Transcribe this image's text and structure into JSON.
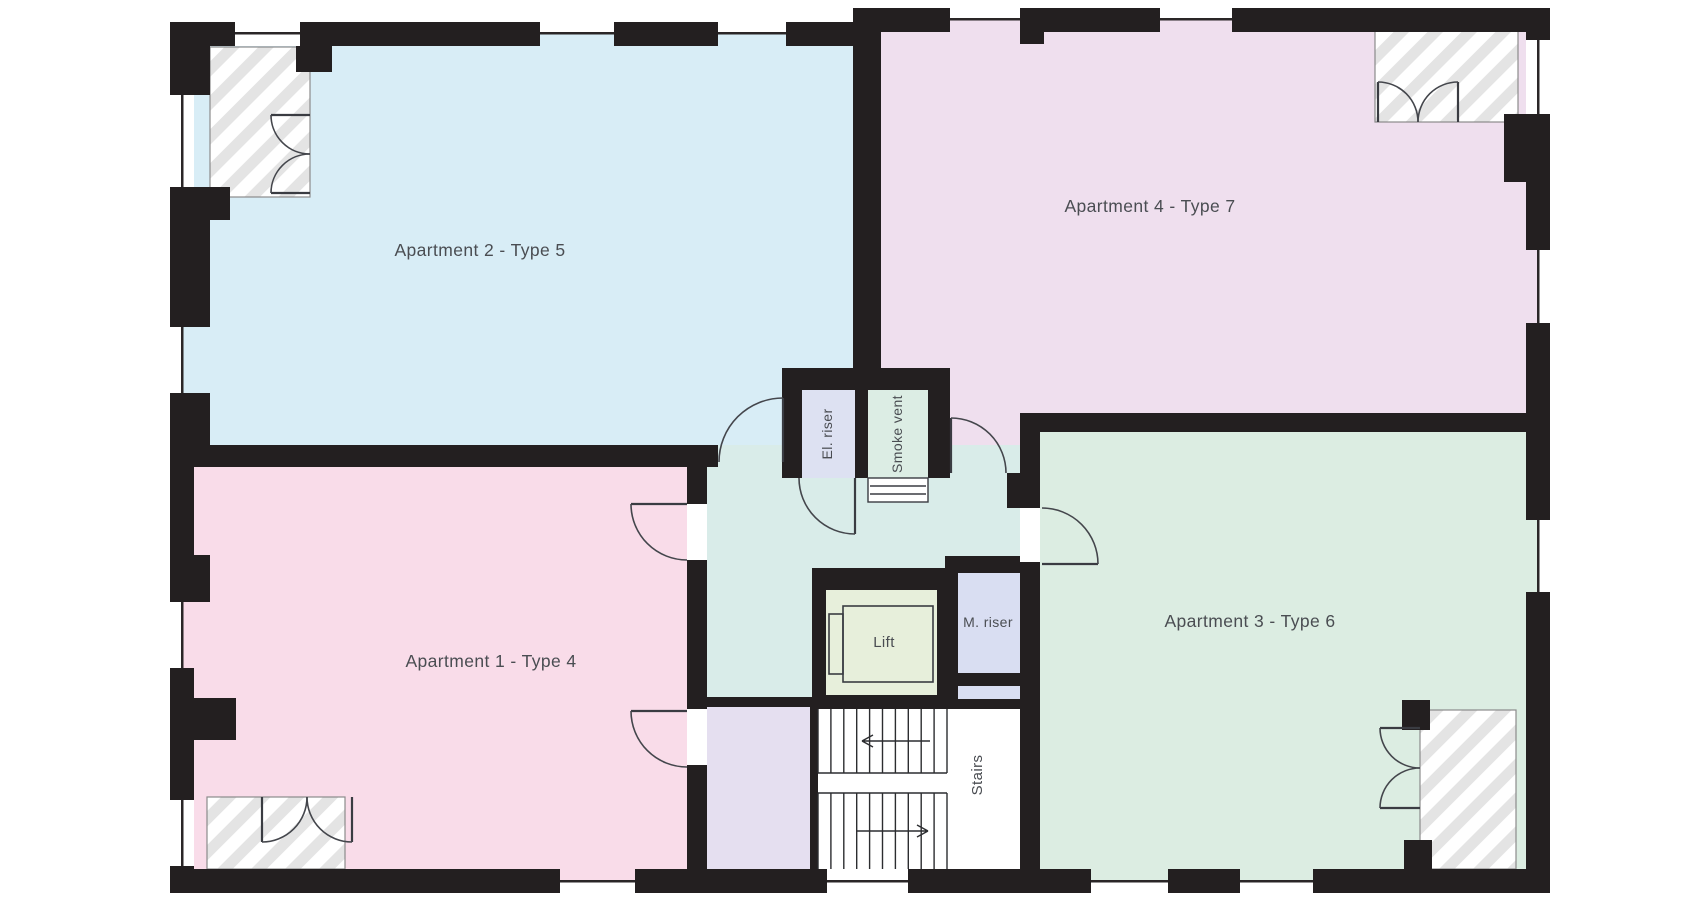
{
  "rooms": {
    "apartment_1": {
      "label": "Apartment 1 - Type 4",
      "color": "#f9dce9"
    },
    "apartment_2": {
      "label": "Apartment 2 - Type 5",
      "color": "#d8edf6"
    },
    "apartment_3": {
      "label": "Apartment 3 - Type 6",
      "color": "#dcede2"
    },
    "apartment_4": {
      "label": "Apartment 4 - Type 7",
      "color": "#efdfee"
    },
    "el_riser": {
      "label": "El. riser",
      "color": "#dde1f2"
    },
    "smoke_vent": {
      "label": "Smoke vent",
      "color": "#dcede4"
    },
    "lift": {
      "label": "Lift",
      "color": "#e7efdb"
    },
    "m_riser": {
      "label": "M. riser",
      "color": "#d9def2"
    },
    "stairs": {
      "label": "Stairs",
      "color": "#ffffff"
    },
    "corridor": {
      "color": "#d9ece9"
    },
    "lobby": {
      "color": "#e5dff0"
    }
  },
  "colors": {
    "wall": "#231f20",
    "label_text": "#4a4d52",
    "hatch": "#e4e4e4",
    "balcony_base": "#ffffff"
  }
}
